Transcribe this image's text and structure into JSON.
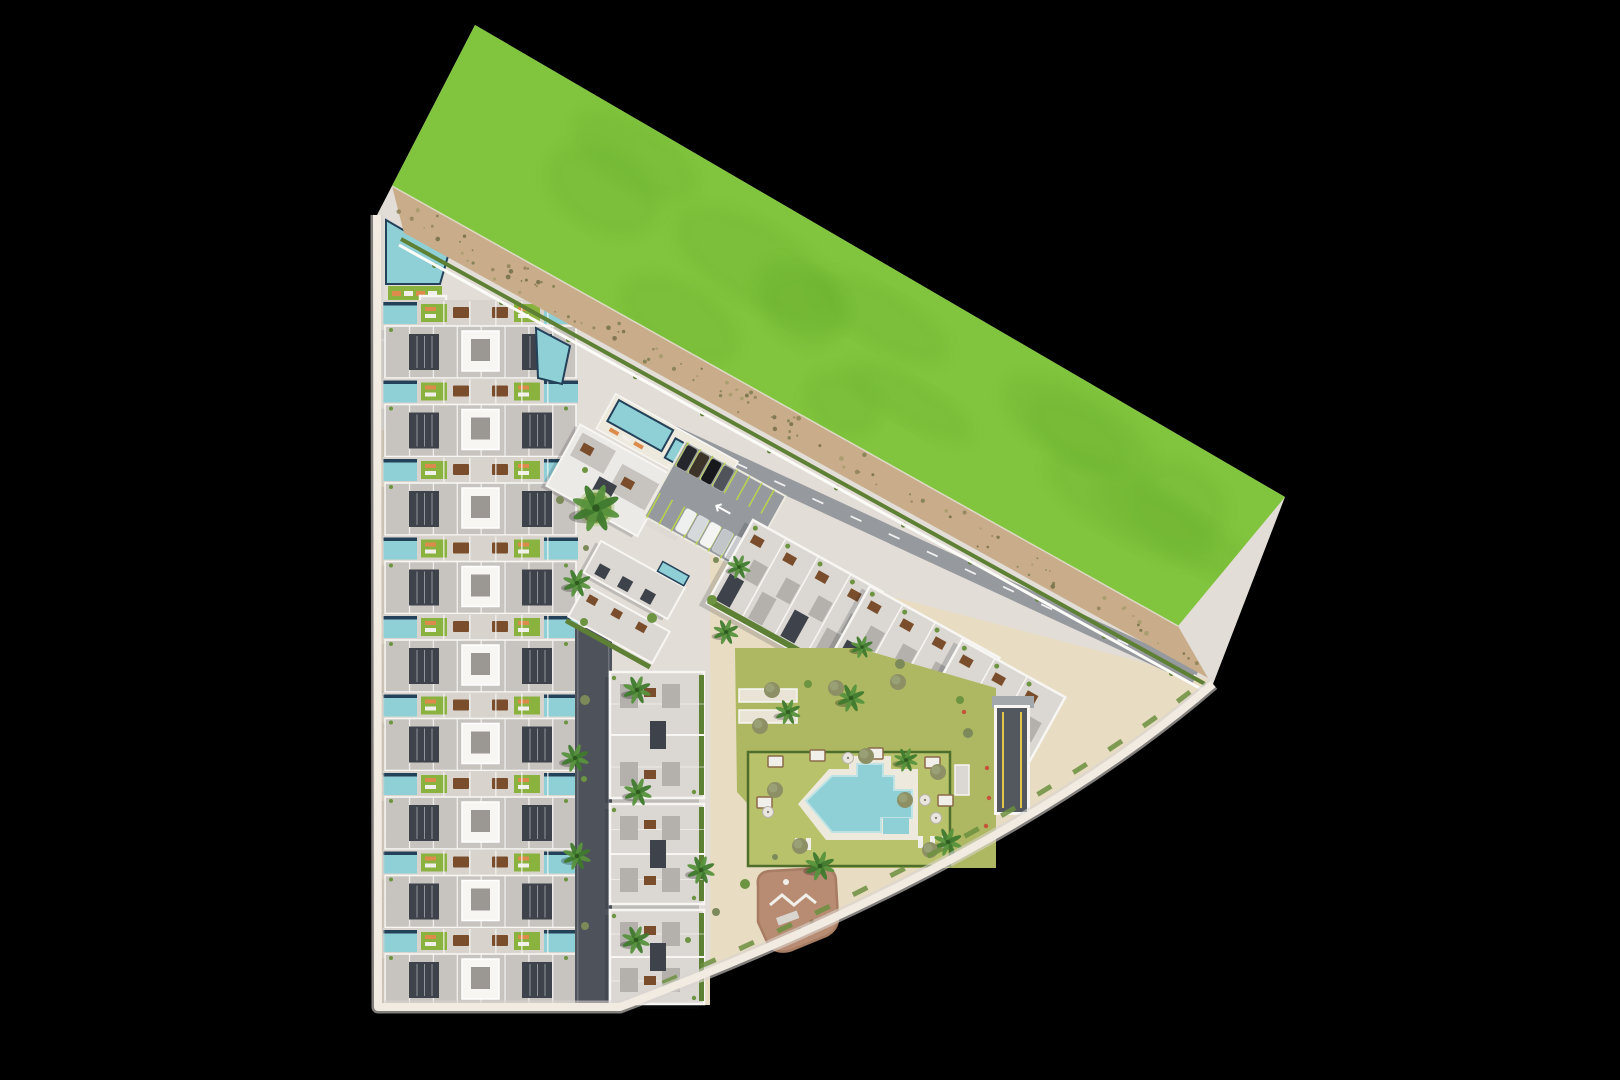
{
  "scene": {
    "name": "residential-masterplan-aerial-render",
    "canvas": {
      "w": 1620,
      "h": 1080,
      "background": "#000000"
    },
    "colors": {
      "pavement": "#e2ddd6",
      "sand": "#e8dcc2",
      "sidewalk": "#f2ebe2",
      "sidewalk_shadow": "#d9d3d0",
      "field": "#81c43e",
      "field_dark": "#6db232",
      "dirt": "#c9ac89",
      "dirt_dark": "#8b8055",
      "hedge": "#5d8034",
      "curb": "#fbfbf8",
      "road_dark": "#4e525a",
      "road_mid": "#96999e",
      "tan_path": "#dac8a7",
      "roof": "#c7c3bf",
      "roof_light": "#dbd7d2",
      "wall": "#f7f6f3",
      "well": "#3e434b",
      "patio": "#b4b0ac",
      "core_slot": "#9b9793",
      "pool": "#8fd0d6",
      "pool_light": "#bfe3e4",
      "navy": "#24415a",
      "lawn": "#8ab23e",
      "lawn_big": "#aeb862",
      "lawn_fenced": "#b8c26b",
      "hedge_dark": "#4e6e2c",
      "palm": "#3f7a2e",
      "palm_light": "#58923d",
      "palm_core": "#2e5a20",
      "olive": "#8d9065",
      "olive_light": "#9aa075",
      "shrub": "#6d9440",
      "table": "#7a4e2c",
      "lounger_o": "#dd8a4d",
      "lounger_w": "#f1efe9",
      "deck": "#edeadd",
      "playground": "#b88c73",
      "playground_edge": "#a77c63",
      "stall": "#b9d44e",
      "ramp": "#53575e",
      "ramp_line": "#e3c44d",
      "ramp_wall": "#a3a8ad",
      "shadow": "rgba(30,34,44,0.18)",
      "white": "#ffffff",
      "flower": "#c4533a",
      "petanque": "#eae4d6",
      "clubhouse": "#eceae6",
      "terrace_path": "#dedad3",
      "amenity_pave": "#d8d4cd"
    },
    "outline": {
      "path": "M475,25 L1285,497 L1213,684 Q1010,860 620,1007 L378,1007 L377,215 Z",
      "sidewalk_path": "M1213,684 Q1010,860 620,1007 L378,1007 L377,215"
    },
    "field": {
      "points": "475,25 1285,497 1178,626 392,186",
      "corners": [
        [
          475,
          25
        ],
        [
          1285,
          497
        ],
        [
          1178,
          626
        ],
        [
          392,
          186
        ]
      ],
      "blob_count": 14
    },
    "band": {
      "points": "392,186 1178,626 1208,678 404,233",
      "corners": [
        [
          392,
          186
        ],
        [
          1178,
          626
        ],
        [
          1208,
          678
        ],
        [
          404,
          233
        ]
      ],
      "speck_count": 110,
      "hedge_line": [
        401,
        239,
        1205,
        684
      ],
      "curb_line": [
        399,
        245,
        1203,
        690
      ],
      "fence_line": [
        392,
        186,
        1178,
        626
      ]
    },
    "sand_area": {
      "path": "M710,549 L1210,680 Q1010,858 624,1005 L710,1005 Z"
    },
    "tan_path": {
      "x": 379,
      "y": 430,
      "w": 20,
      "h": 577
    },
    "dark_road": {
      "x": 575,
      "y": 628,
      "w": 37,
      "h": 378
    },
    "band_road": {
      "line": [
        660,
        428,
        1196,
        676
      ],
      "width": 17,
      "dash": "12 30"
    },
    "boundary_hedge": {
      "path": "M1190,692 Q1000,838 640,993",
      "dash": "16 26"
    },
    "townhouses": {
      "x": 383,
      "y0": 300,
      "pitch": 78.5,
      "count": 9,
      "w": 195,
      "template": {
        "pool_w": 34,
        "pool_h": 22,
        "left_pool_x": 0,
        "right_pool_x": 161,
        "lawns": [
          38,
          131
        ],
        "lawn_w": 26,
        "lawn_h": 18,
        "tables": [
          70,
          109
        ],
        "bld_y": 26,
        "bld_h": 52,
        "wells": [
          26,
          139
        ],
        "well_w": 30,
        "well_h": 36,
        "core_x": 79,
        "core_w": 37,
        "core_h": 40,
        "bays": 8
      },
      "edge_pool": "536,328 570,346 562,384 538,378"
    },
    "corner_garden": {
      "pool": "386,220 448,256 440,284 386,284",
      "grass": {
        "x": 388,
        "y": 286,
        "w": 54,
        "h": 16
      },
      "loungers_x": [
        392,
        404,
        416,
        428
      ],
      "pergola1": {
        "x": 376,
        "y": 304,
        "w": 36,
        "h": 36
      },
      "pergola2": {
        "x": 420,
        "y": 296,
        "w": 26,
        "h": 22
      },
      "table": {
        "cx": 452,
        "cy": 310,
        "r": 6
      }
    },
    "mid_blocks": {
      "x": 610,
      "w": 94,
      "blocks": [
        [
          672,
          126
        ],
        [
          804,
          100
        ],
        [
          910,
          94
        ]
      ]
    },
    "angled_pair": {
      "t": [
        601,
        541
      ],
      "rot": 29
    },
    "clubhouse": {
      "t": [
        596,
        392
      ],
      "rot": 29
    },
    "parking": {
      "t": [
        686,
        441
      ],
      "rot": 29,
      "w": 114,
      "h": 86,
      "car_colors": [
        "#24262b",
        "#3c3329",
        "#17181c",
        "#50545a",
        "#eef0f0",
        "#d6d9db",
        "#f4f4f2",
        "#c2c6c9"
      ],
      "cars": [
        [
          3,
          2,
          0
        ],
        [
          17,
          2,
          1
        ],
        [
          31,
          2,
          2
        ],
        [
          45,
          2,
          3
        ],
        [
          33,
          58,
          4
        ],
        [
          47,
          58,
          5
        ],
        [
          61,
          58,
          6
        ],
        [
          75,
          58,
          7
        ],
        [
          89,
          58,
          4
        ]
      ]
    },
    "right_blocks": {
      "rot": 29,
      "h": 95,
      "list": [
        [
          753,
          520,
          148
        ],
        [
          870,
          586,
          148
        ],
        [
          962,
          640,
          118
        ]
      ]
    },
    "amenity": {
      "lawn_points": "735,648 858,648 996,688 996,868 806,868 737,792",
      "fenced_lawn": {
        "x": 748,
        "y": 752,
        "w": 202,
        "h": 114
      },
      "petanque": [
        [
          739,
          689
        ],
        [
          739,
          710
        ]
      ],
      "petanque_w": 58,
      "petanque_h": 13,
      "deck_path": "M798,804 L829,769 L918,769 L918,840 L826,840 Z",
      "deck_jut": {
        "x": 849,
        "y": 756,
        "w": 42,
        "h": 16
      },
      "water_path": "M806,801 L832,776 L857,776 L857,764 L883,764 L883,776 L894,776 L894,790 L912,790 L912,818 L881,818 L881,832 L832,832 Z",
      "water_jut": {
        "x": 883,
        "y": 818,
        "w": 26,
        "h": 16
      },
      "cabanas": [
        [
          768,
          756
        ],
        [
          810,
          750
        ],
        [
          868,
          748
        ],
        [
          925,
          757
        ],
        [
          757,
          797
        ],
        [
          938,
          795
        ]
      ],
      "loungers": [
        [
          918,
          836
        ],
        [
          930,
          836
        ],
        [
          942,
          836
        ],
        [
          795,
          838
        ],
        [
          806,
          838
        ]
      ],
      "parasols": [
        [
          925,
          800
        ],
        [
          936,
          818
        ],
        [
          768,
          812
        ],
        [
          848,
          758
        ]
      ],
      "pergola": {
        "x": 955,
        "y": 765,
        "w": 14,
        "h": 30
      },
      "flowers": [
        [
          987,
          768
        ],
        [
          989,
          798
        ],
        [
          986,
          826
        ],
        [
          964,
          712
        ]
      ]
    },
    "playground": {
      "path": "M758,886 Q756,872 770,871 L822,868 Q836,868 836,882 L838,918 Q838,930 826,936 L792,950 Q776,955 768,944 L758,922 Z",
      "zigzag": "770,905 782,895 794,905 806,895 816,903",
      "slide": {
        "x": 776,
        "y": 918,
        "w": 22,
        "h": 8
      },
      "dots": [
        [
          812,
          922
        ],
        [
          800,
          930
        ]
      ],
      "spring": [
        786,
        882
      ]
    },
    "ramp": {
      "x": 997,
      "y": 708,
      "w": 30,
      "h": 104,
      "wall": {
        "x": 992,
        "y": 696,
        "w": 42,
        "h": 12
      }
    },
    "vegetation": {
      "palms": [
        [
          596,
          508,
          1.7
        ],
        [
          577,
          583,
          1
        ],
        [
          575,
          758,
          1
        ],
        [
          577,
          856,
          1
        ],
        [
          637,
          690,
          1
        ],
        [
          638,
          792,
          1
        ],
        [
          636,
          940,
          1
        ],
        [
          701,
          870,
          1
        ],
        [
          726,
          632,
          0.9
        ],
        [
          739,
          567,
          0.85
        ],
        [
          851,
          698,
          1
        ],
        [
          788,
          712,
          0.9
        ],
        [
          820,
          866,
          1.05
        ],
        [
          948,
          842,
          1
        ],
        [
          906,
          760,
          0.85
        ],
        [
          862,
          647,
          0.8
        ]
      ],
      "olives": [
        [
          775,
          790
        ],
        [
          800,
          846
        ],
        [
          866,
          756
        ],
        [
          905,
          800
        ],
        [
          938,
          772
        ],
        [
          760,
          726
        ],
        [
          898,
          682
        ],
        [
          836,
          688
        ],
        [
          772,
          690
        ],
        [
          930,
          850
        ]
      ],
      "shrubs": [
        [
          586,
          548
        ],
        [
          584,
          622
        ],
        [
          585,
          700
        ],
        [
          584,
          779
        ],
        [
          585,
          926
        ],
        [
          712,
          600
        ],
        [
          716,
          560
        ],
        [
          960,
          700
        ],
        [
          968,
          733
        ],
        [
          688,
          940
        ],
        [
          716,
          912
        ],
        [
          745,
          884
        ],
        [
          775,
          857
        ],
        [
          808,
          684
        ],
        [
          900,
          664
        ],
        [
          585,
          470
        ],
        [
          560,
          500
        ],
        [
          652,
          618
        ]
      ],
      "planter": {
        "cx": 596,
        "cy": 508,
        "r": 17
      },
      "curb_bushes": 12
    }
  }
}
